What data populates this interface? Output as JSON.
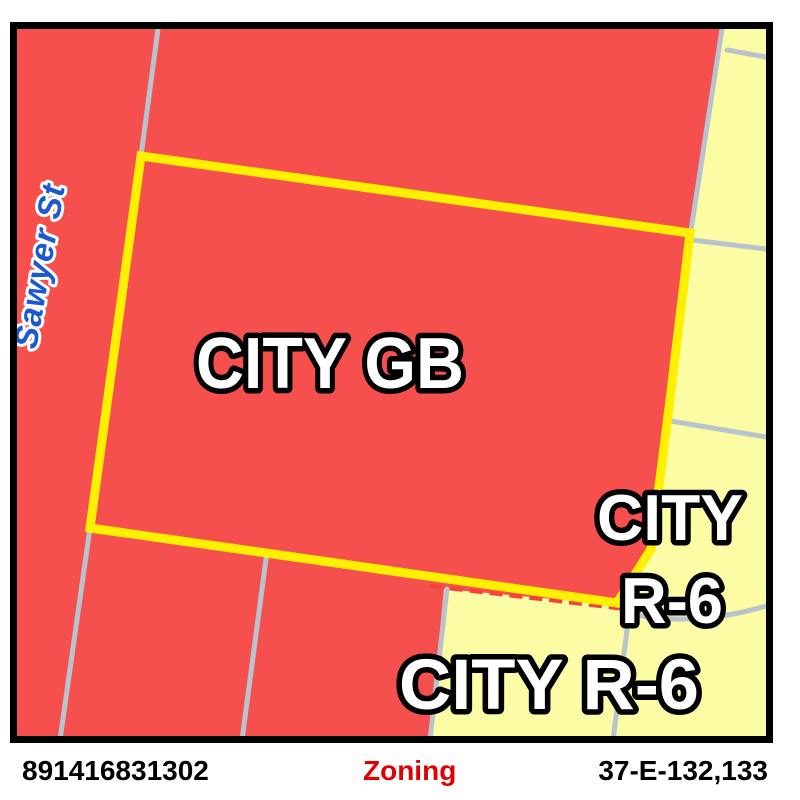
{
  "map": {
    "street_label": "Sawyer St",
    "zones": {
      "gb_label": "CITY GB",
      "r6_right_label_line1": "CITY",
      "r6_right_label_line2": "R-6",
      "r6_bottom_label": "CITY R-6"
    },
    "colors": {
      "zone_gb_fill": "#f5504d",
      "zone_r6_fill": "#fcfca5",
      "selected_parcel_outline": "#ffef00",
      "parcel_line_gray": "#b9c3ce",
      "zone_boundary_dash_red": "#f5413a",
      "street_label_blue": "#1a58d4",
      "map_border_black": "#000000",
      "zoning_text_red": "#e00000"
    }
  },
  "footer": {
    "parcel_id": "891416831302",
    "view_label": "Zoning",
    "sheet_ref": "37-E-132,133"
  }
}
